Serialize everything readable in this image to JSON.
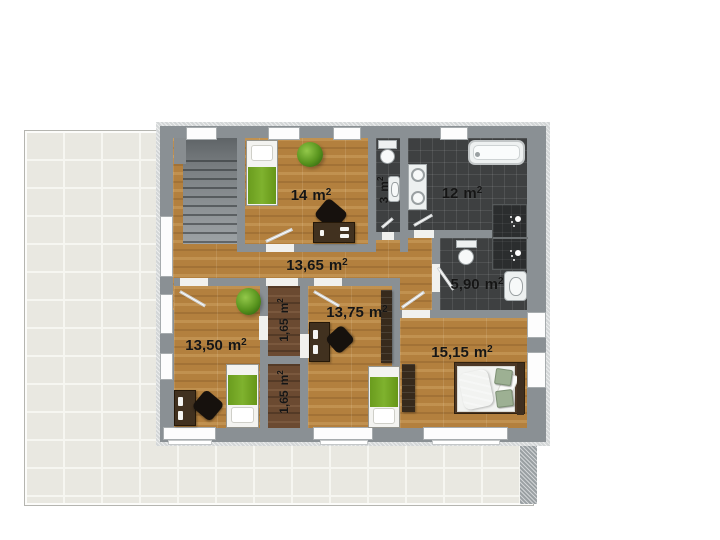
{
  "unit": {
    "base": "m",
    "exponent": "2"
  },
  "rooms": [
    {
      "id": "bedroom-top",
      "area": "14",
      "fixtures": [
        "single-bed-green",
        "potted-plant",
        "desk",
        "office-chair"
      ]
    },
    {
      "id": "wc",
      "area": "3",
      "rotated": true,
      "fixtures": [
        "toilet",
        "washbasin"
      ]
    },
    {
      "id": "bathroom",
      "area": "12",
      "fixtures": [
        "bathtub",
        "double-washbasin",
        "shower-cabin"
      ]
    },
    {
      "id": "hallway",
      "area": "13,65",
      "fixtures": [
        "staircase"
      ]
    },
    {
      "id": "shower-room",
      "area": "5,90",
      "fixtures": [
        "toilet",
        "washbasin",
        "shower-cabin"
      ]
    },
    {
      "id": "bedroom-left",
      "area": "13,50",
      "fixtures": [
        "single-bed-green",
        "potted-plant",
        "desk",
        "office-chair"
      ]
    },
    {
      "id": "closet-upper",
      "area": "1,65",
      "rotated": true,
      "fixtures": []
    },
    {
      "id": "closet-lower",
      "area": "1,65",
      "rotated": true,
      "fixtures": []
    },
    {
      "id": "bedroom-middle",
      "area": "13,75",
      "fixtures": [
        "single-bed-green",
        "desk",
        "office-chair",
        "wardrobe"
      ]
    },
    {
      "id": "bedroom-right",
      "area": "15,15",
      "fixtures": [
        "double-bed",
        "wardrobe"
      ]
    }
  ],
  "palette": {
    "wood_floor": "#b3803e",
    "dark_wood_floor": "#6b4a31",
    "bathroom_tile": "#3e4041",
    "wall": "#8a9094",
    "terrace_tile": "#e9e8e1",
    "bed_blanket_green": "#72a423",
    "bed_blanket_blue": "#7fa9dd",
    "label_text": "#151515"
  }
}
